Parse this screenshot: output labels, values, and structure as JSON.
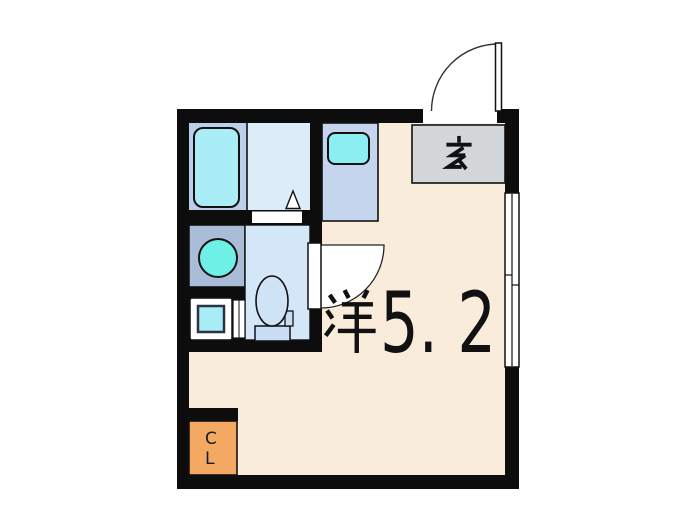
{
  "floorplan": {
    "title_visible_labels": [
      "玄",
      "洋5.2",
      "CL"
    ],
    "main_room": {
      "label": "洋5.2",
      "kanji": "洋",
      "size_text": "5. 2",
      "floor_color": "#faecdb"
    },
    "genkan": {
      "label": "玄",
      "floor_color": "#d3d7da"
    },
    "closet": {
      "label": "CL",
      "letters": [
        "C",
        "L"
      ],
      "floor_color": "#f3a961"
    },
    "bathroom": {
      "tub_area_color": "#bccfe9",
      "floor_color": "#dcecf9",
      "bathtub_color": "#a9eef6"
    },
    "kitchen": {
      "floor_color": "#c6d5ee",
      "sink_color": "#8deef2"
    },
    "washroom": {
      "floor_color": "#a9bdd9",
      "basin_color": "#6ef0e6"
    },
    "toilet_room": {
      "floor_color": "#d4e7f8",
      "fixture_color": "#cfe2f6"
    },
    "laundry": {
      "machine_color": "#a8ecf8"
    },
    "walls_color": "#0d0d0d",
    "fixtures": [
      "bathtub",
      "kitchen-sink",
      "wash-basin",
      "toilet",
      "washing-machine",
      "entrance-door",
      "room-door",
      "sliding-window",
      "bath-door"
    ]
  }
}
